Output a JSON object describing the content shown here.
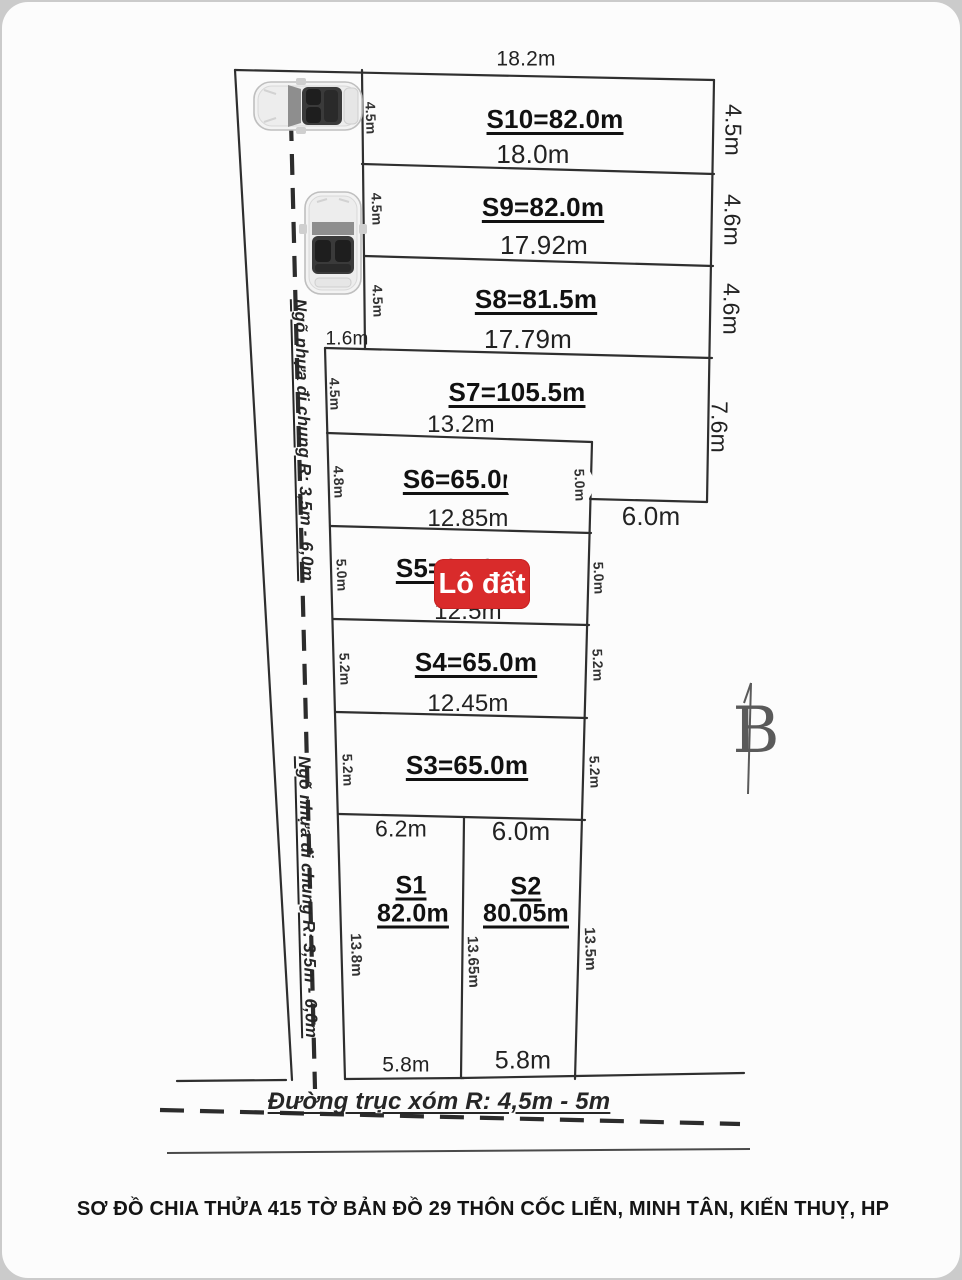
{
  "page": {
    "title": "SƠ ĐỒ CHIA THỬA 415 TỜ BẢN ĐỒ 29 THÔN CỐC LIỄN, MINH TÂN, KIẾN THUỴ, HP",
    "badge_label": "Lô đất",
    "colors": {
      "badge_red": "#d92b2b",
      "line": "#2f2f2f",
      "paper": "#fcfcfc"
    }
  },
  "roads": {
    "left_alley_label_upper": "Ngõ nhựa đi chung R: 3,5m - 6,0m",
    "left_alley_label_lower": "Ngõ nhựa đi chung R: 3,5m - 6,0m",
    "bottom_road_label": "Đường trục xóm R: 4,5m - 5m"
  },
  "dimensions": {
    "top_width": "18.2m",
    "step_width": "1.6m",
    "s7_right_bottom_width": "6.0m",
    "right_side": [
      "4.5m",
      "4.6m",
      "4.6m",
      "7.6m"
    ]
  },
  "plots": {
    "s10": {
      "label": "S10=82.0m",
      "bottom": "18.0m",
      "left": "4.5m"
    },
    "s9": {
      "label": "S9=82.0m",
      "bottom": "17.92m",
      "left": "4.5m"
    },
    "s8": {
      "label": "S8=81.5m",
      "bottom": "17.79m",
      "left": "4.5m"
    },
    "s7": {
      "label": "S7=105.5m",
      "bottom": "13.2m",
      "left": "4.5m"
    },
    "s6": {
      "label": "S6=65.0m",
      "bottom": "12.85m",
      "left": "4.8m",
      "right": "5.0m"
    },
    "s5": {
      "label": "S5=65.0m",
      "bottom": "12.5m",
      "left": "5.0m",
      "right": "5.0m"
    },
    "s4": {
      "label": "S4=65.0m",
      "bottom": "12.45m",
      "left": "5.2m",
      "right": "5.2m"
    },
    "s3": {
      "label": "S3=65.0m",
      "left": "5.2m",
      "right": "5.2m"
    },
    "s1": {
      "name": "S1",
      "area": "82.0m",
      "top": "6.2m",
      "bottom": "5.8m",
      "left": "13.8m",
      "mid": "13.65m"
    },
    "s2": {
      "name": "S2",
      "area": "80.05m",
      "top": "6.0m",
      "bottom": "5.8m",
      "right": "13.5m"
    }
  },
  "compass": {
    "north_letter": "B"
  }
}
